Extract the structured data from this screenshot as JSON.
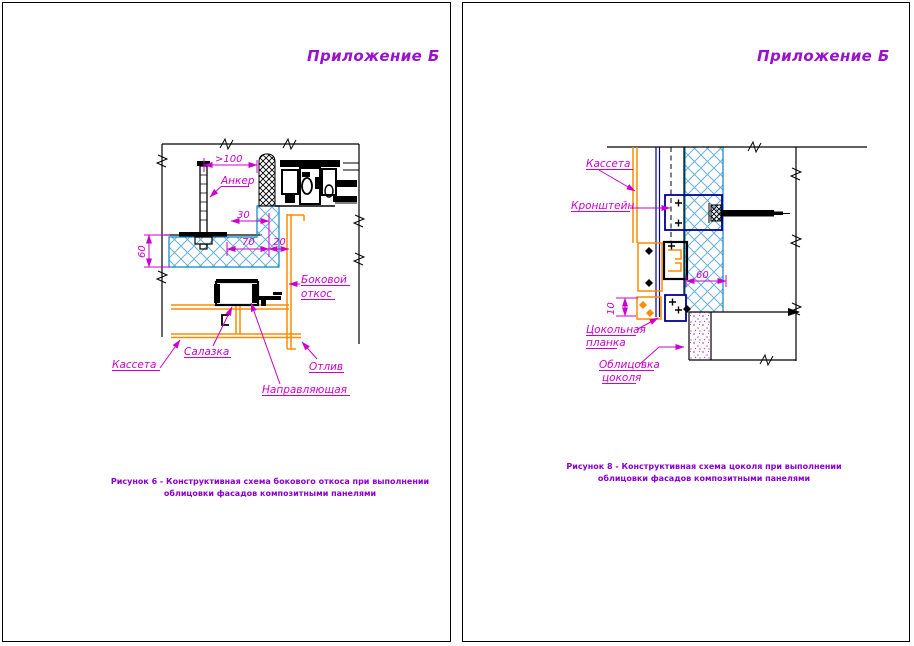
{
  "document": {
    "type": "CAD drawing sheets",
    "colors": {
      "annotation_magenta": "#cc00cc",
      "title_purple": "#9912cc",
      "caption_purple": "#8a00d0",
      "cassette_orange": "#ff8c00",
      "insulation_blue": "#0b87c4",
      "hatch_blue": "#69b0dc",
      "bracket_navy": "#000099",
      "line_black": "#000000"
    }
  },
  "sheet_left": {
    "title": "Приложение Б",
    "caption": [
      "Рисунок 6 - Конструктивная схема бокового откоса при выполнении",
      "облицовки фасадов композитными панелями"
    ],
    "dims": {
      "d100": ">100",
      "d30": "30",
      "d70": "70",
      "d20": "20",
      "d60": "60"
    },
    "labels": {
      "anchor": "Анкер",
      "side_reveal_1": "Боковой",
      "side_reveal_2": "откос",
      "cassette": "Кассета",
      "slide": "Салазка",
      "drip": "Отлив",
      "rail": "Направляющая"
    }
  },
  "sheet_right": {
    "title": "Приложение Б",
    "caption": [
      "Рисунок 8 - Конструктивная схема цоколя при выполнении",
      "облицовки фасадов композитными панелями"
    ],
    "dims": {
      "d60": "60",
      "d10": "10"
    },
    "labels": {
      "cassette": "Кассета",
      "bracket": "Кронштейн",
      "plinth_strip_1": "Цокольная",
      "plinth_strip_2": "планка",
      "plinth_cladding_1": "Облицовка",
      "plinth_cladding_2": "цоколя"
    }
  }
}
